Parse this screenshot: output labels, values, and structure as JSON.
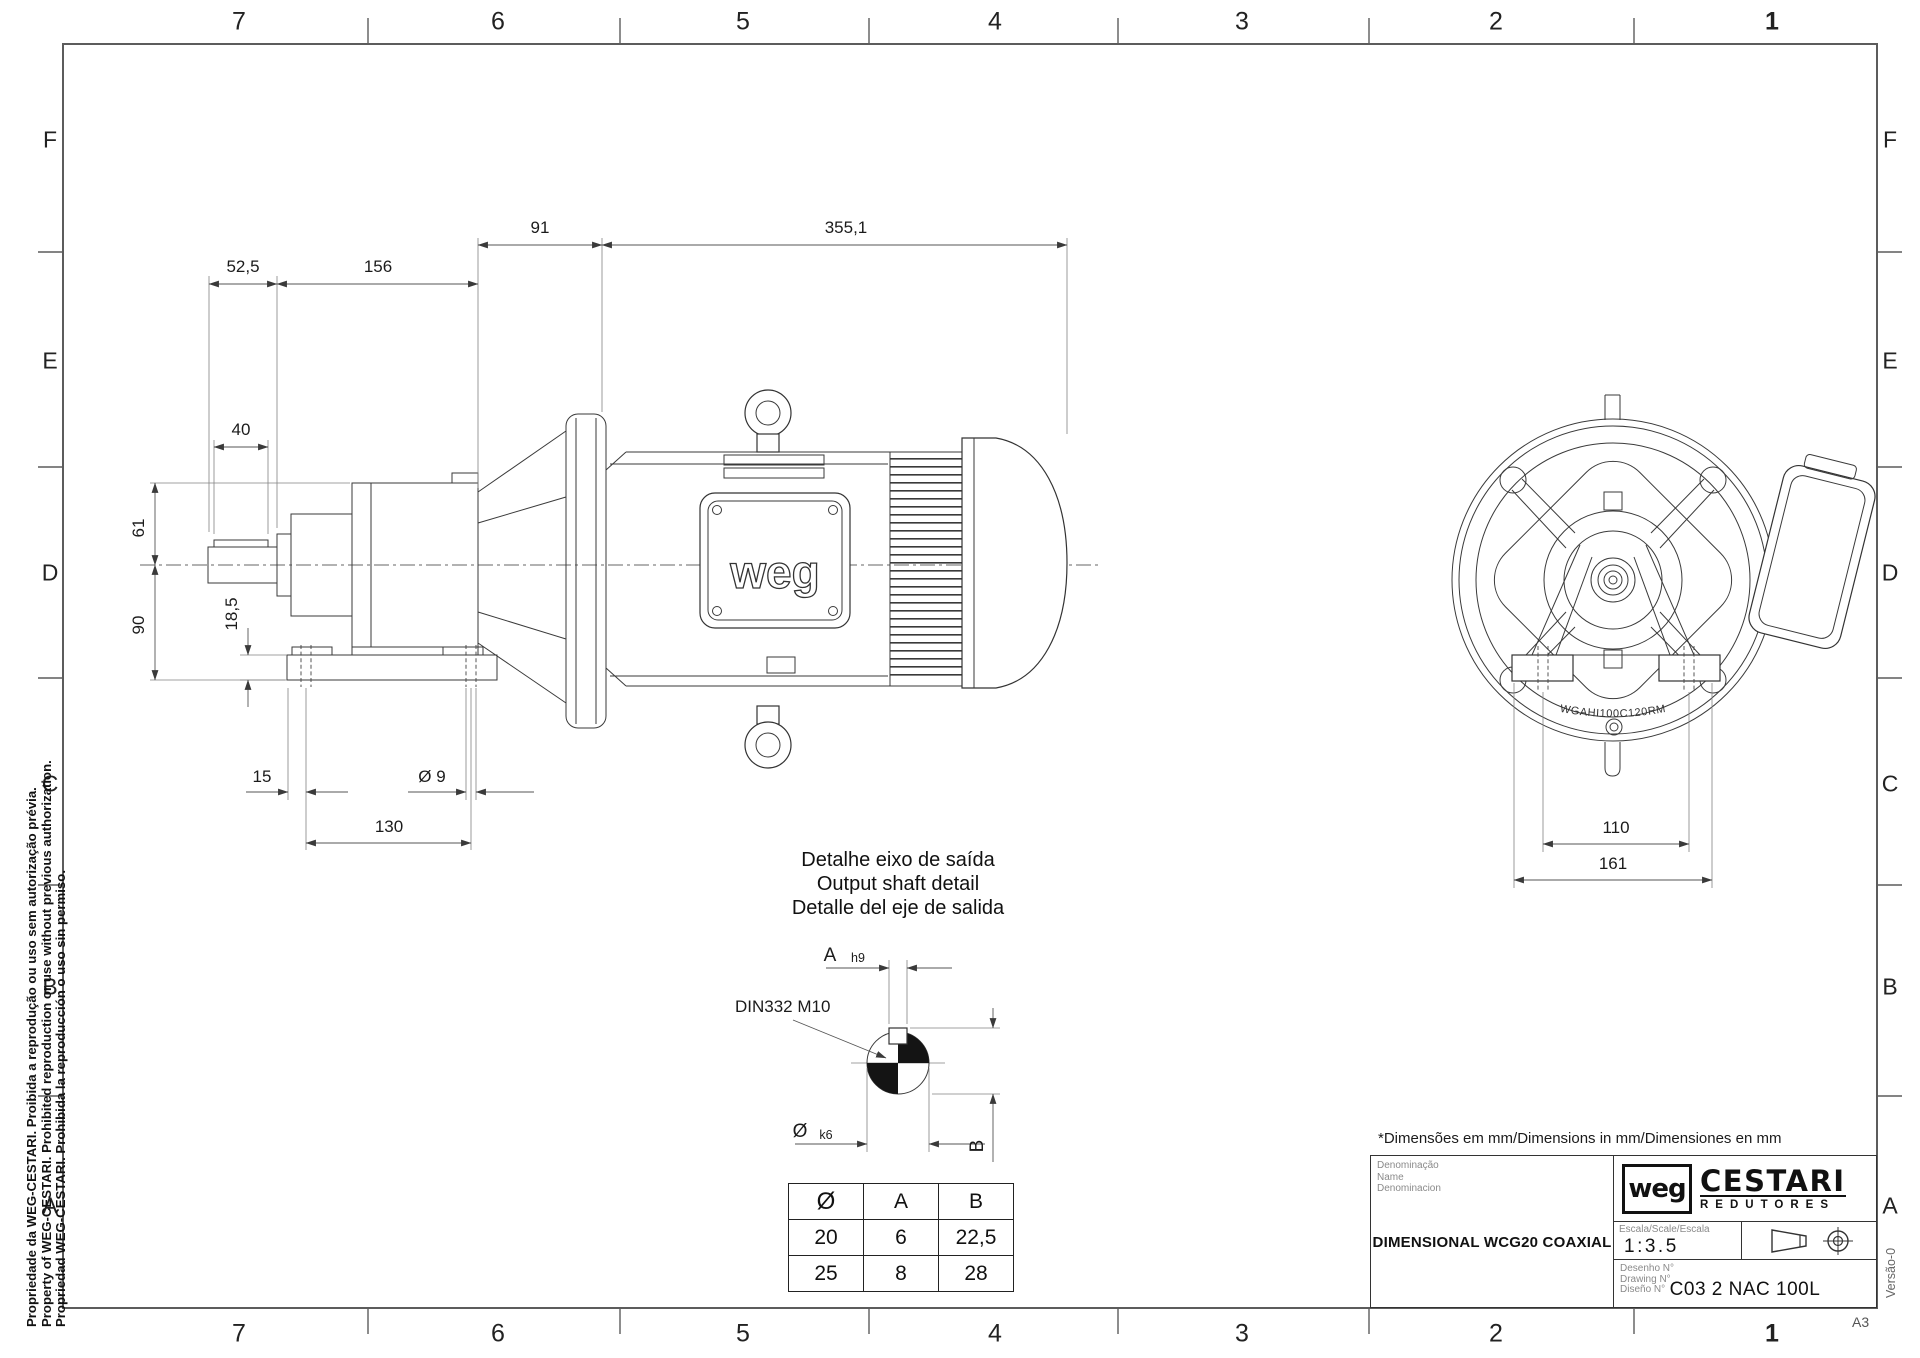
{
  "sheet": {
    "format": "A3",
    "version": "Versão-0"
  },
  "grid": {
    "cols": [
      "7",
      "6",
      "5",
      "4",
      "3",
      "2",
      "1"
    ],
    "rows": [
      "F",
      "E",
      "D",
      "C",
      "B",
      "A"
    ]
  },
  "copyright": {
    "line1": "Propriedade da WEG-CESTARI. Proibida a reprodução ou uso sem autorização prévia.",
    "line2": "Property of WEG-CESTARI. Prohibited reproduction or use without previous authorization.",
    "line3": "Propriedad WEG-CESTARI. Prohibida la reproducción o uso sin permiso."
  },
  "side_view": {
    "motor_logo": "weg",
    "dims": {
      "a": "52,5",
      "b": "156",
      "c": "91",
      "d": "355,1",
      "e": "40",
      "f": "61",
      "g": "90",
      "h": "18,5",
      "i": "15",
      "j": "130",
      "k": "Ø 9"
    }
  },
  "front_view": {
    "flange_code": "WGAHI100C120RM",
    "dims": {
      "bolt_spacing": "110",
      "base_width": "161"
    }
  },
  "shaft_detail": {
    "title_pt": "Detalhe eixo de saída",
    "title_en": "Output shaft detail",
    "title_es": "Detalle del eje de salida",
    "center_drill": "DIN332 M10",
    "dim_a": "A",
    "tol_a": "h9",
    "dim_dia": "Ø",
    "tol_dia": "k6",
    "dim_b": "B",
    "table": {
      "headers": [
        "Ø",
        "A",
        "B"
      ],
      "rows": [
        [
          "20",
          "6",
          "22,5"
        ],
        [
          "25",
          "8",
          "28"
        ]
      ]
    }
  },
  "notes": {
    "units": "*Dimensões em mm/Dimensions in mm/Dimensiones en mm"
  },
  "title_block": {
    "name_labels": [
      "Denominação",
      "Name",
      "Denominacion"
    ],
    "title": "DIMENSIONAL WCG20 COAXIAL",
    "brand": {
      "weg": "weg",
      "name": "CESTARI",
      "division": "REDUTORES"
    },
    "scale_label": "Escala/Scale/Escala",
    "scale_value": "1:3.5",
    "drawing_labels": [
      "Desenho  N°",
      "Drawing  N°",
      "Diseño  N°"
    ],
    "drawing_number": "C03 2 NAC 100L"
  }
}
